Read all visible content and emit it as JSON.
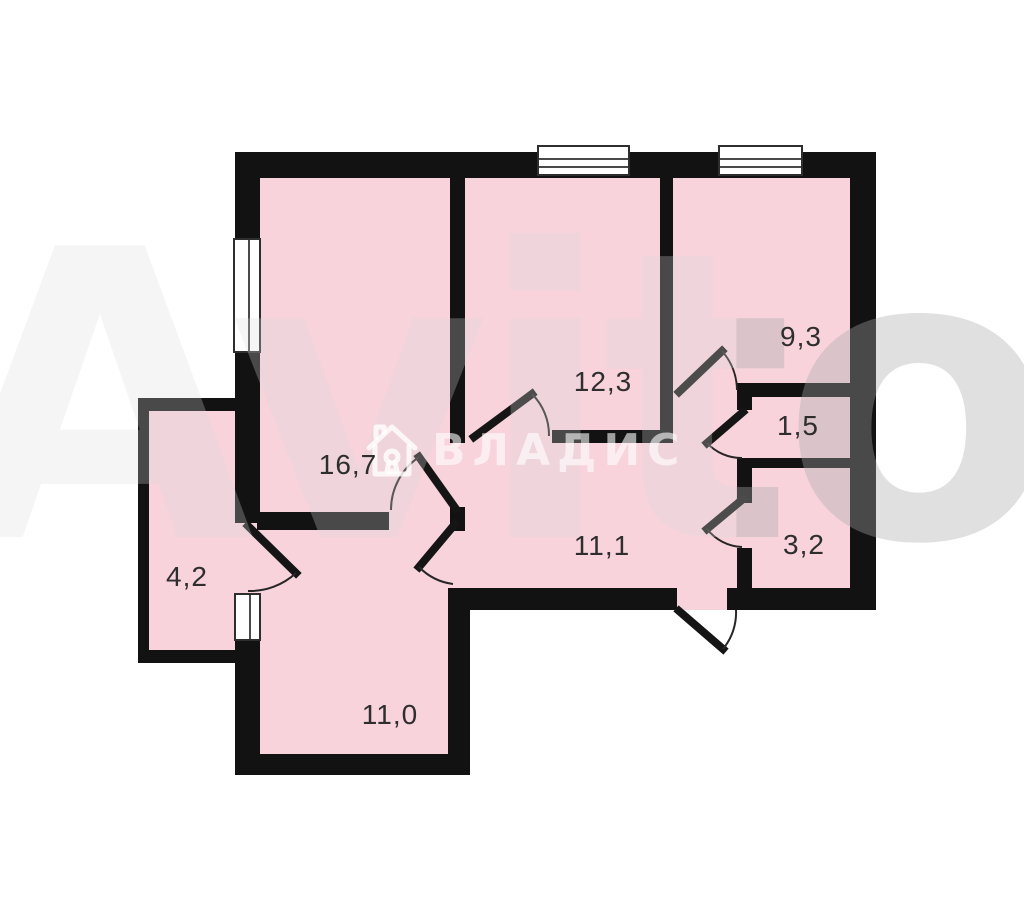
{
  "plan": {
    "canvas": {
      "width": 1024,
      "height": 898
    },
    "colors": {
      "room_fill": "#f8d3dc",
      "wall": "#121212",
      "background": "#ffffff",
      "label_text": "#2e2e2e"
    },
    "rooms": [
      {
        "id": "room-16-7",
        "area_label": "16,7",
        "rect": [
          235,
          152,
          230,
          378
        ],
        "label_pos": [
          348,
          465
        ]
      },
      {
        "id": "room-12-3",
        "area_label": "12,3",
        "rect": [
          450,
          152,
          223,
          291
        ],
        "label_pos": [
          603,
          382
        ]
      },
      {
        "id": "room-9-3",
        "area_label": "9,3",
        "rect": [
          660,
          152,
          216,
          245
        ],
        "label_pos": [
          801,
          337
        ]
      },
      {
        "id": "room-1-5",
        "area_label": "1,5",
        "rect": [
          737,
          383,
          139,
          85
        ],
        "label_pos": [
          798,
          426
        ]
      },
      {
        "id": "room-3-2",
        "area_label": "3,2",
        "rect": [
          737,
          458,
          139,
          152
        ],
        "label_pos": [
          804,
          545
        ]
      },
      {
        "id": "hallway-11-1",
        "area_label": "11,1",
        "rect": [
          450,
          443,
          302,
          167
        ],
        "label_pos": [
          602,
          546
        ]
      },
      {
        "id": "hall-connector",
        "area_label": "",
        "rect": [
          660,
          397,
          92,
          46
        ],
        "label_pos": null
      },
      {
        "id": "room-11-0",
        "area_label": "11,0",
        "rect": [
          235,
          513,
          235,
          262
        ],
        "label_pos": [
          390,
          715
        ]
      },
      {
        "id": "room-4-2",
        "area_label": "4,2",
        "rect": [
          138,
          398,
          122,
          265
        ],
        "label_pos": [
          187,
          577
        ]
      }
    ],
    "walls": [
      [
        235,
        152,
        641,
        26
      ],
      [
        850,
        152,
        26,
        458
      ],
      [
        235,
        152,
        25,
        90
      ],
      [
        235,
        353,
        25,
        170
      ],
      [
        235,
        641,
        25,
        115
      ],
      [
        235,
        754,
        235,
        21
      ],
      [
        448,
        588,
        22,
        187
      ],
      [
        448,
        588,
        229,
        22
      ],
      [
        727,
        588,
        149,
        22
      ],
      [
        138,
        398,
        11,
        265
      ],
      [
        138,
        398,
        99,
        13
      ],
      [
        138,
        650,
        122,
        13
      ],
      [
        450,
        152,
        15,
        291
      ],
      [
        450,
        507,
        15,
        24
      ],
      [
        257,
        512,
        132,
        18
      ],
      [
        660,
        152,
        13,
        291
      ],
      [
        552,
        430,
        115,
        13
      ],
      [
        737,
        383,
        113,
        14
      ],
      [
        737,
        383,
        15,
        27
      ],
      [
        737,
        458,
        113,
        10
      ],
      [
        737,
        458,
        15,
        45
      ],
      [
        737,
        548,
        15,
        50
      ]
    ],
    "windows": [
      {
        "rect": [
          537,
          145,
          93,
          31
        ],
        "orient": "h"
      },
      {
        "rect": [
          718,
          145,
          85,
          31
        ],
        "orient": "h"
      },
      {
        "rect": [
          233,
          238,
          28,
          115
        ],
        "orient": "v"
      },
      {
        "rect": [
          234,
          593,
          27,
          48
        ],
        "orient": "v"
      }
    ],
    "doors": [
      {
        "id": "door-room-16-7",
        "leaf": "M456,509 L419,457",
        "arc": "M419,457 A64,64 0 0 0 391,510"
      },
      {
        "id": "door-room-11-0",
        "leaf": "M455,524 L419,567",
        "arc": "M419,567 A58,58 0 0 0 453,584"
      },
      {
        "id": "door-room-4-2",
        "leaf": "M248,526 L296,573",
        "arc": "M296,573 A68,68 0 0 1 248,591"
      },
      {
        "id": "door-room-12-3",
        "leaf": "M474,437 L532,394",
        "arc": "M532,394 A58,58 0 0 1 549,436"
      },
      {
        "id": "door-room-9-3",
        "leaf": "M679,392 L722,351",
        "arc": "M722,351 A60,60 0 0 1 737,390"
      },
      {
        "id": "door-room-1-5",
        "leaf": "M743,412 L707,443",
        "arc": "M707,443 A47,47 0 0 0 742,458"
      },
      {
        "id": "door-room-3-2",
        "leaf": "M743,499 L707,529",
        "arc": "M707,529 A47,47 0 0 0 742,547"
      },
      {
        "id": "door-entrance",
        "leaf": "M679,611 L723,649",
        "arc": "M723,649 A57,57 0 0 0 736,610"
      }
    ]
  },
  "watermark": {
    "brand": "ВЛАДИС",
    "site_word": "Avito"
  }
}
